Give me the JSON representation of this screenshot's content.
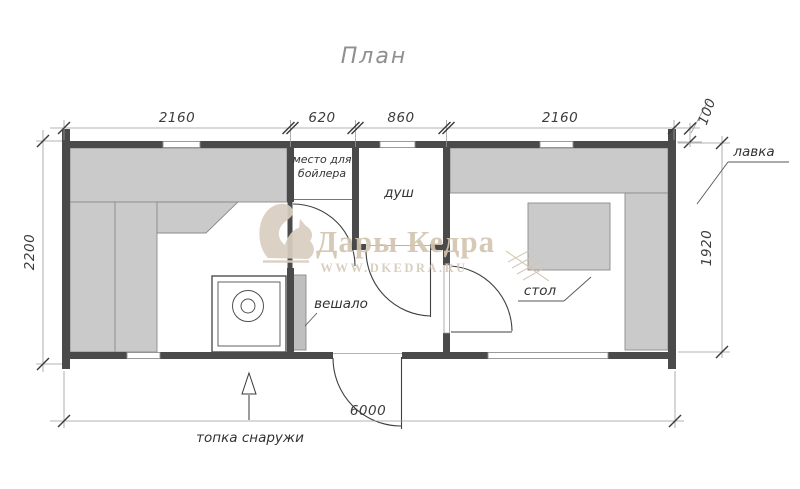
{
  "title": "План",
  "watermark": {
    "brand": "Дары Кедра",
    "url": "WWW.DKEDRA.RU"
  },
  "dimensions": {
    "top_left_room": "2160",
    "top_boiler": "620",
    "top_shower": "860",
    "top_right_room": "2160",
    "top_overhang": "100",
    "left_height": "2200",
    "right_inner_height": "1920",
    "bottom_total": "6000"
  },
  "labels": {
    "boiler_line1": "место для",
    "boiler_line2": "бойлера",
    "shower": "душ",
    "hanger": "вешало",
    "table": "стол",
    "bench": "лавка",
    "furnace_note": "топка снаружи"
  },
  "colors": {
    "wall": "#4a4a4a",
    "bench": "#cacaca",
    "watermark_text": "#d3c5b0",
    "dim_text": "#3c3c3c"
  }
}
